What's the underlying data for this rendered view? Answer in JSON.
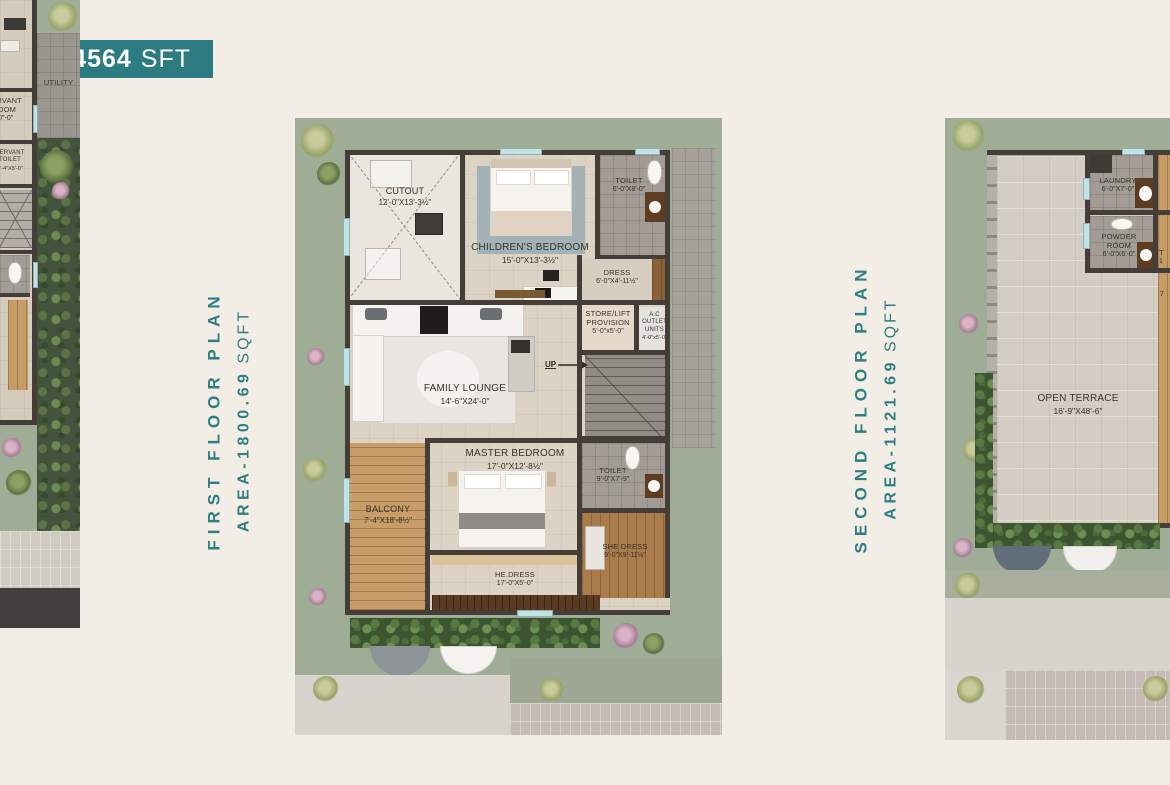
{
  "badge": {
    "bold": "BUA 4564",
    "light": "SFT"
  },
  "colors": {
    "accent_teal": "#2c7b80",
    "background_cream": "#f2ede5",
    "plan_green": "#9fac96",
    "wall": "#453e38"
  },
  "floors": {
    "first": {
      "title": "FIRST FLOOR PLAN",
      "area_value": "AREA-1800.69",
      "area_unit": "SQFT"
    },
    "second": {
      "title": "SECOND FLOOR PLAN",
      "area_value": "AREA-1121.69",
      "area_unit": "SQFT"
    }
  },
  "ground_partial": {
    "utility": {
      "name": "UTILITY"
    },
    "servant_room": {
      "name_l1": "SERVANT",
      "name_l2": "ROOM",
      "dim": "X7'-0\""
    },
    "servant_toilet": {
      "name_l1": "SERVANT",
      "name_l2": "TOILET",
      "dim": "3'-4\"X5'-0\""
    }
  },
  "first_floor": {
    "cutout": {
      "name": "CUTOUT",
      "dim": "12'-0\"X13'-3½\""
    },
    "childrens_bedroom": {
      "name": "CHILDREN'S BEDROOM",
      "dim": "15'-0\"X13'-3½\""
    },
    "toilet_top": {
      "name": "TOILET",
      "dim": "6'-0\"X8'-0\""
    },
    "dress": {
      "name": "DRESS",
      "dim": "6'-0\"X4'-11½\""
    },
    "store_lift": {
      "name_l1": "STORE/LIFT",
      "name_l2": "PROVISION",
      "dim": "5'-0\"x5'-0\""
    },
    "ac_outlet": {
      "name_l1": "A.C OUTLET",
      "name_l2": "UNITS",
      "dim": "4'-0\"x5'-0\""
    },
    "family_lounge": {
      "name": "FAMILY LOUNGE",
      "dim": "14'-6\"X24'-0\""
    },
    "up": "UP",
    "master_bedroom": {
      "name": "MASTER BEDROOM",
      "dim": "17'-0\"X12'-8½\""
    },
    "balcony": {
      "name": "BALCONY",
      "dim": "7'-4\"X18'-8½\""
    },
    "toilet_master": {
      "name": "TOILET",
      "dim": "9'-0\"X7'-9\""
    },
    "he_dress": {
      "name": "HE.DRESS",
      "dim": "17'-0\"X5'-0\""
    },
    "she_dress": {
      "name": "SHE DRESS",
      "dim": "9'-0\"X9'-11½\""
    }
  },
  "second_floor": {
    "open_terrace": {
      "name": "OPEN TERRACE",
      "dim": "16'-9\"X48'-6\""
    },
    "laundry": {
      "name": "LAUNDRY",
      "dim": "6'-0\"X7'-0\""
    },
    "powder_room": {
      "name_l1": "POWDER",
      "name_l2": "ROOM",
      "dim": "6'-0\"X6'-0\""
    },
    "toilet_partial": {
      "l1": "T",
      "l2": "1"
    },
    "dim_fragment": "7"
  }
}
